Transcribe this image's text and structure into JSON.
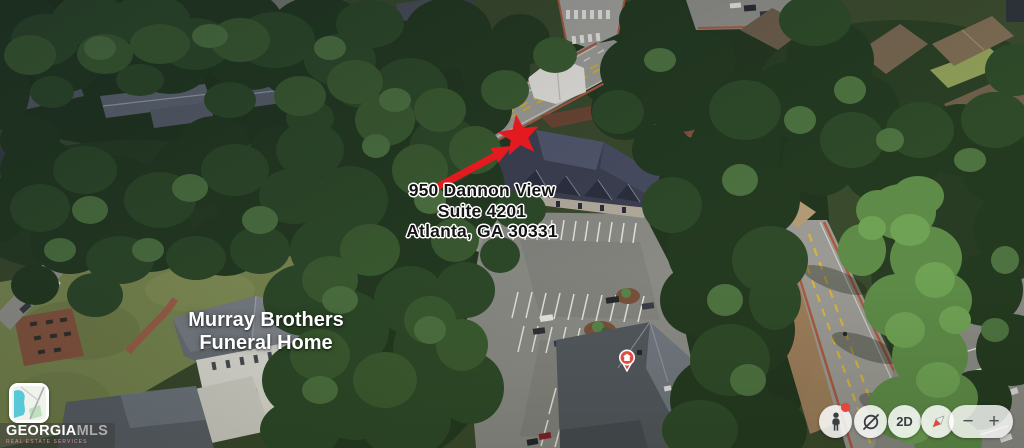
{
  "annotations": {
    "address": {
      "line1": "950 Dannon View",
      "line2": "Suite 4201",
      "line3": "Atlanta, GA 30331"
    },
    "business": {
      "line1": "Murray Brothers",
      "line2": "Funeral Home"
    },
    "marker_red": "#e31b20",
    "place_pin_red": "#e14b3f"
  },
  "watermark": {
    "brand": "GEORGIA",
    "brand_suffix": "MLS",
    "tagline": "REAL ESTATE SERVICES"
  },
  "controls": {
    "view_toggle_label": "2D",
    "zoom_out_label": "−",
    "zoom_in_label": "+",
    "icons": {
      "pegman": "pegman-icon",
      "tilt": "tilt-orbit-icon",
      "compass": "compass-icon"
    },
    "pegman_badge_color": "#e8453c"
  }
}
